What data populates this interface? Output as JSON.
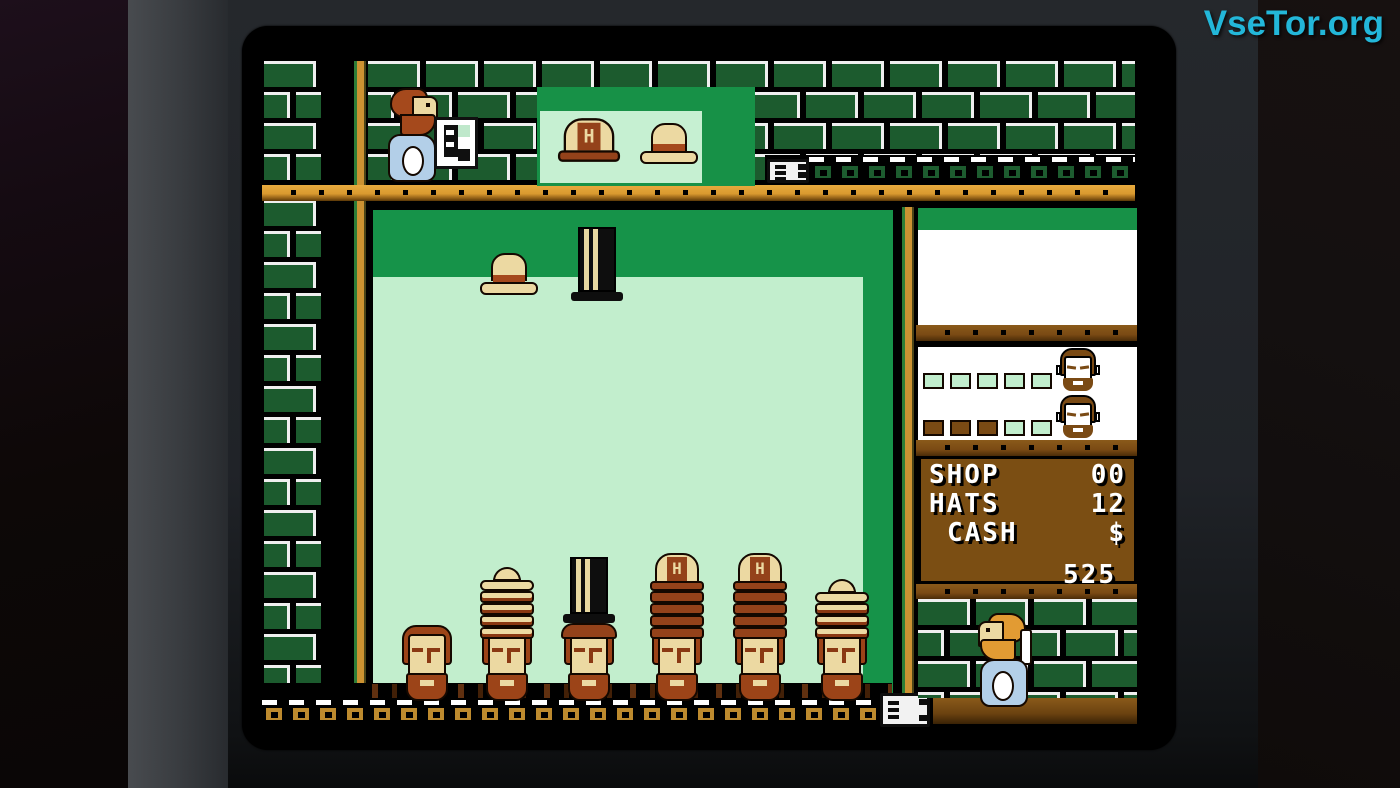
{
  "watermark": {
    "text": "VseTor.org",
    "color": "#23b7d9"
  },
  "hud": {
    "lines": [
      {
        "label": "SHOP",
        "value": "00"
      },
      {
        "label": "HATS",
        "value": "12"
      },
      {
        "label": "CASH",
        "value": "$"
      }
    ],
    "cash_amount": "525"
  },
  "preview": {
    "hats": [
      "hard-hat",
      "boater"
    ],
    "helmet_letter": "H"
  },
  "falling_pieces": [
    {
      "type": "boater"
    },
    {
      "type": "top-hat"
    }
  ],
  "customers": [
    {
      "meter": [
        0,
        0,
        0,
        0,
        0
      ]
    },
    {
      "meter": [
        1,
        1,
        1,
        0,
        0
      ]
    }
  ],
  "heads": [
    {
      "x": 140,
      "stack": []
    },
    {
      "x": 220,
      "stack": [
        "boater",
        "brim-c",
        "brim-c",
        "brim-c",
        "brim-c"
      ]
    },
    {
      "x": 302,
      "stack": [
        "tophat",
        "derby"
      ]
    },
    {
      "x": 390,
      "stack": [
        "helmet",
        "brim-b",
        "brim-b",
        "brim-b",
        "brim-b"
      ]
    },
    {
      "x": 473,
      "stack": [
        "helmet",
        "brim-b",
        "brim-b",
        "brim-b",
        "brim-b"
      ]
    },
    {
      "x": 555,
      "stack": [
        "boater",
        "brim-c",
        "brim-c",
        "brim-c"
      ]
    }
  ],
  "colors": {
    "playfield_green": "#169349",
    "playfield_mint": "#c2eecd",
    "brick_green": "#1c5b2e",
    "beam_gold": "#d9992f",
    "panel_brown": "#7b4e13",
    "hat_cream": "#ecd9a2",
    "hat_derby": "#94421a",
    "skin": "#ecd9a2",
    "shirt_blue": "#b3cfe8"
  }
}
